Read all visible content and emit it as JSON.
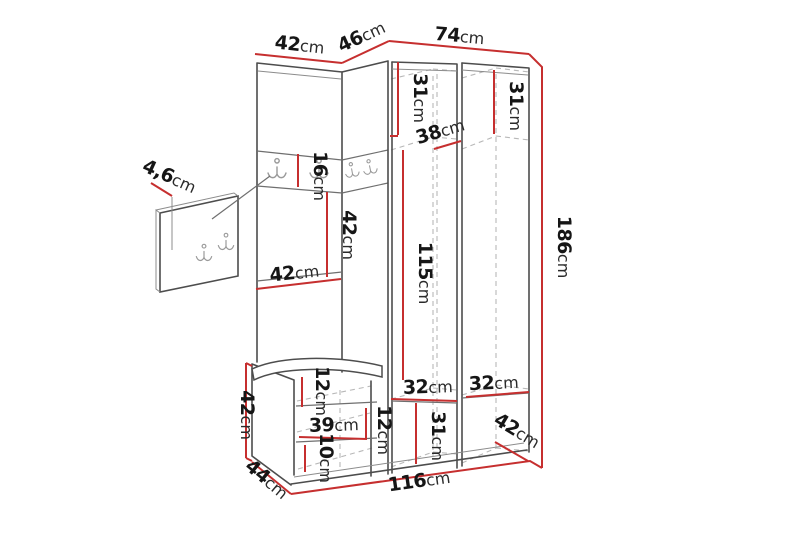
{
  "diagram": {
    "title": "hallway-furniture-dimension-diagram",
    "unit": "cm",
    "labels": {
      "top_width_left": {
        "value": "42",
        "unit": "cm"
      },
      "top_width_corner": {
        "value": "46",
        "unit": "cm"
      },
      "top_width_right": {
        "value": "74",
        "unit": "cm"
      },
      "top_shelf_depth_mid": {
        "value": "31",
        "unit": "cm"
      },
      "top_shelf_depth_right": {
        "value": "31",
        "unit": "cm"
      },
      "corner_shelf_width": {
        "value": "38",
        "unit": "cm"
      },
      "total_height": {
        "value": "186",
        "unit": "cm"
      },
      "hook_panel_size": {
        "value": "4,6",
        "unit": "cm"
      },
      "hook_band_height": {
        "value": "16",
        "unit": "cm"
      },
      "open_space_height": {
        "value": "42",
        "unit": "cm"
      },
      "left_cabinet_width": {
        "value": "42",
        "unit": "cm"
      },
      "hanging_space_height": {
        "value": "115",
        "unit": "cm"
      },
      "bench_height": {
        "value": "42",
        "unit": "cm"
      },
      "bench_top_gap": {
        "value": "12",
        "unit": "cm"
      },
      "bench_inner_width": {
        "value": "39",
        "unit": "cm"
      },
      "bench_mid_gap": {
        "value": "12",
        "unit": "cm"
      },
      "bench_bottom_gap": {
        "value": "10",
        "unit": "cm"
      },
      "bench_depth": {
        "value": "44",
        "unit": "cm"
      },
      "total_width": {
        "value": "116",
        "unit": "cm"
      },
      "bottom_shelf_width_mid": {
        "value": "32",
        "unit": "cm"
      },
      "bottom_shelf_width_right": {
        "value": "32",
        "unit": "cm"
      },
      "bottom_space_height": {
        "value": "31",
        "unit": "cm"
      },
      "right_cabinet_depth": {
        "value": "42",
        "unit": "cm"
      }
    },
    "colors": {
      "measurement_line": "#c62f2f",
      "outline": "#4d4d4d",
      "hidden_line": "#b8b8b8",
      "background": "#ffffff"
    }
  }
}
